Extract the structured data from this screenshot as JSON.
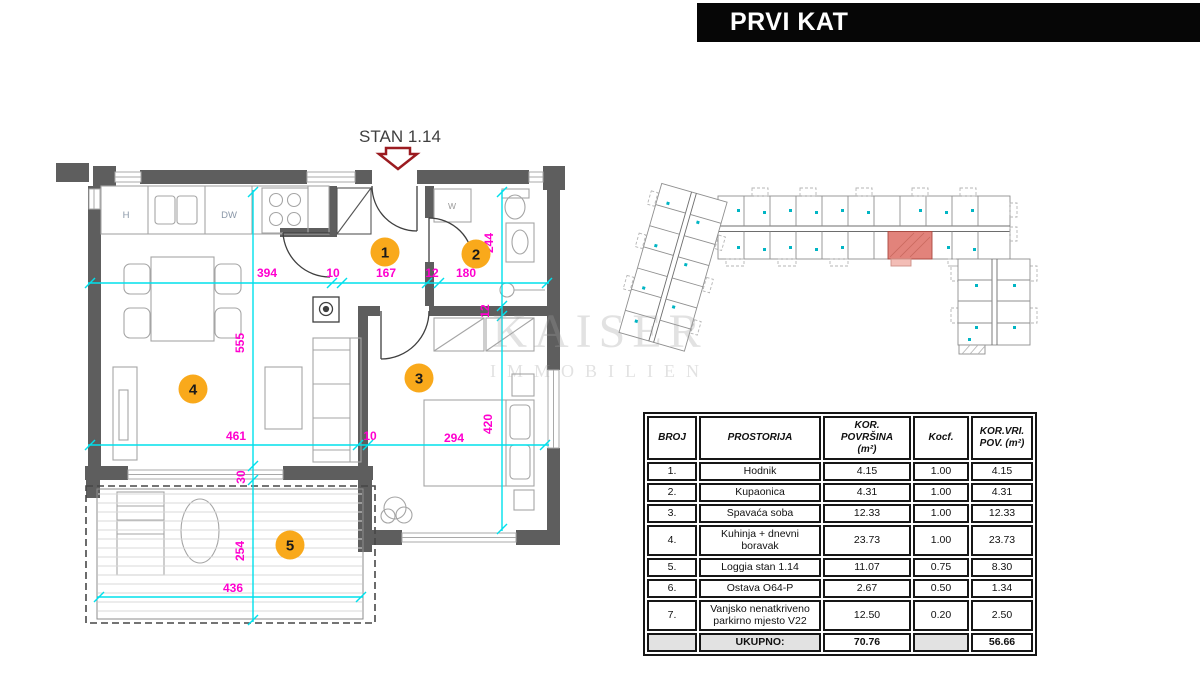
{
  "banner": {
    "title": "PRVI KAT"
  },
  "watermark": {
    "line1": "KAISER",
    "line2": "IMMOBILIEN"
  },
  "floor_plan": {
    "unit_label": "STAN 1.14",
    "fixture_labels": {
      "hood": "H",
      "dishwasher": "DW",
      "washer": "W"
    },
    "room_markers": [
      {
        "num": "1",
        "x": 385,
        "y": 252
      },
      {
        "num": "2",
        "x": 476,
        "y": 254
      },
      {
        "num": "3",
        "x": 419,
        "y": 378
      },
      {
        "num": "4",
        "x": 193,
        "y": 389
      },
      {
        "num": "5",
        "x": 290,
        "y": 545
      }
    ],
    "dim_labels": [
      {
        "text": "394",
        "x": 267,
        "y": 277,
        "rot": 0
      },
      {
        "text": "10",
        "x": 333,
        "y": 277,
        "rot": 0
      },
      {
        "text": "167",
        "x": 386,
        "y": 277,
        "rot": 0
      },
      {
        "text": "12",
        "x": 432,
        "y": 277,
        "rot": 0
      },
      {
        "text": "180",
        "x": 466,
        "y": 277,
        "rot": 0
      },
      {
        "text": "461",
        "x": 236,
        "y": 440,
        "rot": 0
      },
      {
        "text": "10",
        "x": 370,
        "y": 440,
        "rot": 0
      },
      {
        "text": "294",
        "x": 454,
        "y": 442,
        "rot": 0
      },
      {
        "text": "436",
        "x": 233,
        "y": 592,
        "rot": 0
      },
      {
        "text": "244",
        "x": 493,
        "y": 243,
        "rot": -90
      },
      {
        "text": "555",
        "x": 244,
        "y": 343,
        "rot": -90
      },
      {
        "text": "420",
        "x": 492,
        "y": 424,
        "rot": -90
      },
      {
        "text": "30",
        "x": 245,
        "y": 477,
        "rot": -90
      },
      {
        "text": "254",
        "x": 244,
        "y": 551,
        "rot": -90
      },
      {
        "text": "12",
        "x": 489,
        "y": 311,
        "rot": -90
      }
    ]
  },
  "table": {
    "headers": [
      "BROJ",
      "PROSTORIJA",
      "KOR.\nPOVRŠINA\n(m²)",
      "Kocf.",
      "KOR.VRI.\nPOV. (m²)"
    ],
    "rows": [
      [
        "1.",
        "Hodnik",
        "4.15",
        "1.00",
        "4.15"
      ],
      [
        "2.",
        "Kupaonica",
        "4.31",
        "1.00",
        "4.31"
      ],
      [
        "3.",
        "Spavaća soba",
        "12.33",
        "1.00",
        "12.33"
      ],
      [
        "4.",
        "Kuhinja + dnevni\nboravak",
        "23.73",
        "1.00",
        "23.73"
      ],
      [
        "5.",
        "Loggia stan 1.14",
        "11.07",
        "0.75",
        "8.30"
      ],
      [
        "6.",
        "Ostava O64-P",
        "2.67",
        "0.50",
        "1.34"
      ],
      [
        "7.",
        "Vanjsko nenatkriveno\nparkirno mjesto V22",
        "12.50",
        "0.20",
        "2.50"
      ]
    ],
    "total_row": [
      "",
      "UKUPNO:",
      "70.76",
      "",
      "56.66"
    ]
  },
  "colors": {
    "banner_bg": "#000000",
    "banner_text": "#FFFFFF",
    "dimension_text": "#FF00CF",
    "dimension_line": "#00E0EC",
    "marker_fill": "#F9A91B",
    "marker_text": "#1A1A1A",
    "wall": "#5E5E5E",
    "highlight_unit": "#E2837B",
    "arrow_red": "#9B1B20"
  }
}
